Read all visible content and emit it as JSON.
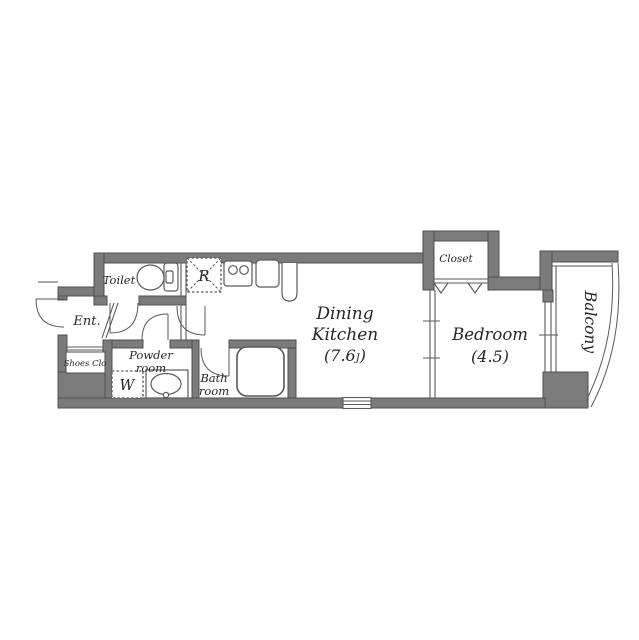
{
  "colors": {
    "wall": "#7b7b7b",
    "wall_edge": "#4f4f4f",
    "line": "#5a5a5a",
    "text": "#262626",
    "background": "#ffffff"
  },
  "labels": {
    "toilet": "Toilet",
    "entrance": "Ent.",
    "shoes_closet": "Shoes Clo",
    "powder_room_line1": "Powder",
    "powder_room_line2": "room",
    "washing_machine": "W",
    "refrigerator": "R",
    "bath_room_line1": "Bath",
    "bath_room_line2": "room",
    "dining_kitchen_line1": "Dining",
    "dining_kitchen_line2": "Kitchen",
    "dining_kitchen_size_prefix": "(7.6",
    "dining_kitchen_size_unit": "J",
    "dining_kitchen_size_suffix": ")",
    "closet": "Closet",
    "bedroom": "Bedroom",
    "bedroom_size": "(4.5)",
    "balcony": "Balcony"
  }
}
